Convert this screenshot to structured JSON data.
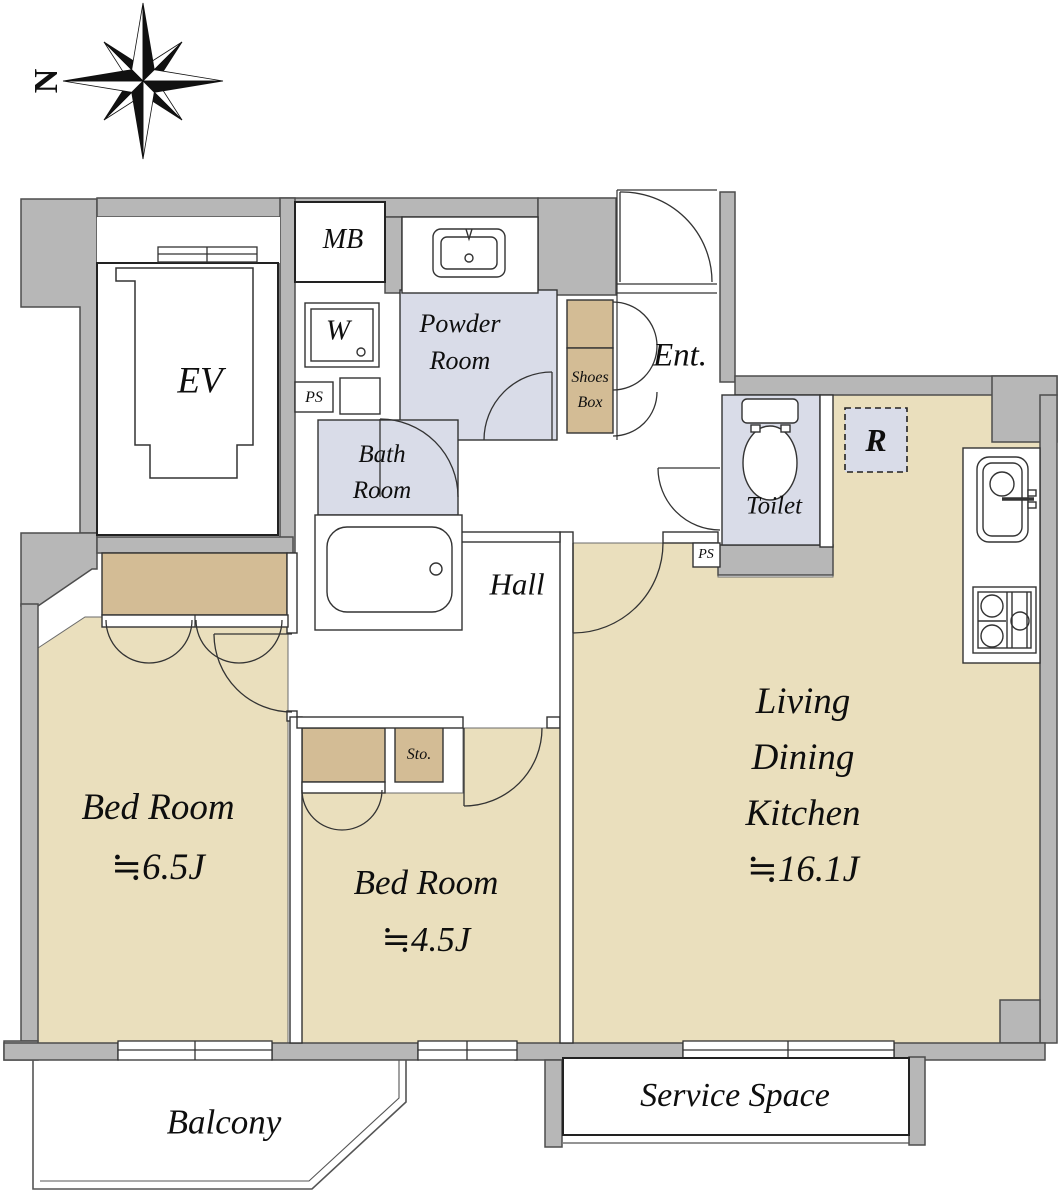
{
  "compass": {
    "north": "N"
  },
  "rooms": {
    "elevator": {
      "label": "EV"
    },
    "meter_box": {
      "label": "MB"
    },
    "powder_room": {
      "line1": "Powder",
      "line2": "Room"
    },
    "washing_machine": {
      "label": "W"
    },
    "pipe_space_left": {
      "label": "PS"
    },
    "pipe_space_right": {
      "label": "PS"
    },
    "shoes_box": {
      "line1": "Shoes",
      "line2": "Box"
    },
    "entrance": {
      "label": "Ent."
    },
    "bath_room": {
      "line1": "Bath",
      "line2": "Room"
    },
    "toilet": {
      "label": "Toilet"
    },
    "refrigerator": {
      "label": "R"
    },
    "hall": {
      "label": "Hall"
    },
    "living_dining_kitchen": {
      "line1": "Living",
      "line2": "Dining",
      "line3": "Kitchen",
      "size": "≒16.1J"
    },
    "bedroom_1": {
      "name": "Bed Room",
      "size": "≒6.5J"
    },
    "bedroom_2": {
      "name": "Bed Room",
      "size": "≒4.5J"
    },
    "storage": {
      "label": "Sto."
    },
    "balcony": {
      "label": "Balcony"
    },
    "service_space": {
      "label": "Service Space"
    }
  },
  "colors": {
    "wall_gray": "#b7b7b7",
    "floor_tan": "#eadfbd",
    "closet_tan": "#d3bc95",
    "wet_area_blue": "#d9dce8",
    "outline": "#4d4d4d"
  }
}
